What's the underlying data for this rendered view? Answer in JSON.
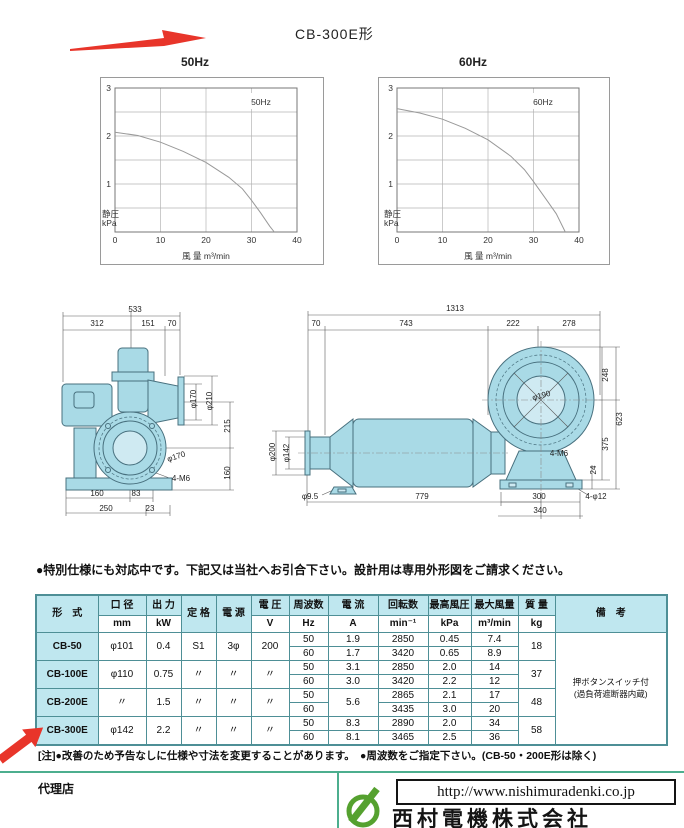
{
  "page_title": "CB-300E形",
  "chart_data": [
    {
      "type": "line",
      "title": "50Hz",
      "inner_label": "50Hz",
      "xlabel": "風 量  m³/min",
      "ylabel_lines": [
        "静圧",
        "kPa"
      ],
      "xlim": [
        0,
        40
      ],
      "ylim": [
        0,
        3
      ],
      "xticks": [
        0,
        10,
        20,
        30,
        40
      ],
      "yticks": [
        1,
        2,
        3
      ],
      "grid_x": [
        10,
        20,
        30
      ],
      "grid_y": [
        0.5,
        1,
        1.5,
        2,
        2.5
      ],
      "series": [
        {
          "name": "50Hz static pressure curve",
          "points": [
            [
              0,
              2.08
            ],
            [
              5,
              2.01
            ],
            [
              10,
              1.87
            ],
            [
              15,
              1.68
            ],
            [
              20,
              1.45
            ],
            [
              25,
              1.14
            ],
            [
              28,
              0.9
            ],
            [
              30,
              0.66
            ],
            [
              32,
              0.4
            ],
            [
              34,
              0.12
            ],
            [
              35,
              0
            ]
          ]
        }
      ]
    },
    {
      "type": "line",
      "title": "60Hz",
      "inner_label": "60Hz",
      "xlabel": "風 量  m³/min",
      "ylabel_lines": [
        "静圧",
        "kPa"
      ],
      "xlim": [
        0,
        40
      ],
      "ylim": [
        0,
        3
      ],
      "xticks": [
        0,
        10,
        20,
        30,
        40
      ],
      "yticks": [
        1,
        2,
        3
      ],
      "grid_x": [
        10,
        20,
        30
      ],
      "grid_y": [
        0.5,
        1,
        1.5,
        2,
        2.5
      ],
      "series": [
        {
          "name": "60Hz static pressure curve",
          "points": [
            [
              0,
              2.57
            ],
            [
              5,
              2.48
            ],
            [
              10,
              2.35
            ],
            [
              15,
              2.16
            ],
            [
              20,
              1.92
            ],
            [
              25,
              1.58
            ],
            [
              28,
              1.3
            ],
            [
              30,
              1.05
            ],
            [
              33,
              0.65
            ],
            [
              35,
              0.38
            ],
            [
              37,
              0
            ]
          ]
        }
      ]
    }
  ],
  "drawings": {
    "left": {
      "labels": [
        {
          "t": "533",
          "x": 85,
          "y": 14
        },
        {
          "t": "312",
          "x": 47,
          "y": 28
        },
        {
          "t": "151",
          "x": 98,
          "y": 28
        },
        {
          "t": "70",
          "x": 122,
          "y": 28
        },
        {
          "t": "φ170",
          "x": 146,
          "y": 101,
          "r": -90
        },
        {
          "t": "φ210",
          "x": 162,
          "y": 103,
          "r": -90
        },
        {
          "t": "215",
          "x": 180,
          "y": 128,
          "r": -90
        },
        {
          "t": "160",
          "x": 180,
          "y": 175,
          "r": -90
        },
        {
          "t": "φ170",
          "x": 127,
          "y": 161,
          "r": -18
        },
        {
          "t": "4-M6",
          "x": 131,
          "y": 183
        },
        {
          "t": "160",
          "x": 47,
          "y": 198
        },
        {
          "t": "83",
          "x": 86,
          "y": 198
        },
        {
          "t": "250",
          "x": 56,
          "y": 213
        },
        {
          "t": "23",
          "x": 100,
          "y": 213
        }
      ]
    },
    "right": {
      "labels": [
        {
          "t": "1313",
          "x": 197,
          "y": 16
        },
        {
          "t": "70",
          "x": 58,
          "y": 31
        },
        {
          "t": "743",
          "x": 148,
          "y": 31
        },
        {
          "t": "222",
          "x": 255,
          "y": 31
        },
        {
          "t": "278",
          "x": 311,
          "y": 31
        },
        {
          "t": "248",
          "x": 350,
          "y": 80,
          "r": -90
        },
        {
          "t": "623",
          "x": 364,
          "y": 124,
          "r": -90
        },
        {
          "t": "375",
          "x": 350,
          "y": 149,
          "r": -90
        },
        {
          "t": "24",
          "x": 338,
          "y": 175,
          "r": -90
        },
        {
          "t": "φ190",
          "x": 284,
          "y": 103,
          "r": -15
        },
        {
          "t": "4-M6",
          "x": 301,
          "y": 161
        },
        {
          "t": "φ200",
          "x": 17,
          "y": 157,
          "r": -90
        },
        {
          "t": "φ142",
          "x": 31,
          "y": 158,
          "r": -90
        },
        {
          "t": "φ9.5",
          "x": 52,
          "y": 204
        },
        {
          "t": "779",
          "x": 164,
          "y": 204
        },
        {
          "t": "300",
          "x": 281,
          "y": 204
        },
        {
          "t": "340",
          "x": 282,
          "y": 218
        },
        {
          "t": "4-φ12",
          "x": 338,
          "y": 204
        }
      ]
    }
  },
  "spec_note": "●特別仕様にも対応中です。下記又は当社へお引合下さい。設計用は専用外形図をご請求ください。",
  "table": {
    "columns": [
      {
        "label": "形　式"
      },
      {
        "label": "口 径",
        "unit": "mm"
      },
      {
        "label": "出 力",
        "unit": "kW"
      },
      {
        "label": "定 格"
      },
      {
        "label": "電 源"
      },
      {
        "label": "電 圧",
        "unit": "V"
      },
      {
        "label": "周波数",
        "unit": "Hz"
      },
      {
        "label": "電 流",
        "unit": "A"
      },
      {
        "label": "回転数",
        "unit": "min⁻¹"
      },
      {
        "label": "最高風圧",
        "unit": "kPa"
      },
      {
        "label": "最大風量",
        "unit": "m³/min"
      },
      {
        "label": "質 量",
        "unit": "kg"
      },
      {
        "label": "備　考"
      }
    ],
    "rows": [
      {
        "model": "CB-50",
        "bore": "φ101",
        "power": "0.4",
        "rating": "S1",
        "source": "3φ",
        "voltage": "200",
        "mass": "18",
        "freq": [
          {
            "hz": "50",
            "a": "1.9",
            "rpm": "2850",
            "kpa": "0.45",
            "flow": "7.4"
          },
          {
            "hz": "60",
            "a": "1.7",
            "rpm": "3420",
            "kpa": "0.65",
            "flow": "8.9"
          }
        ]
      },
      {
        "model": "CB-100E",
        "bore": "φ110",
        "power": "0.75",
        "rating": "〃",
        "source": "〃",
        "voltage": "〃",
        "mass": "37",
        "freq": [
          {
            "hz": "50",
            "a": "3.1",
            "rpm": "2850",
            "kpa": "2.0",
            "flow": "14"
          },
          {
            "hz": "60",
            "a": "3.0",
            "rpm": "3420",
            "kpa": "2.2",
            "flow": "12"
          }
        ]
      },
      {
        "model": "CB-200E",
        "bore": "〃",
        "power": "1.5",
        "rating": "〃",
        "source": "〃",
        "voltage": "〃",
        "mass": "48",
        "a_merged": "5.6",
        "freq": [
          {
            "hz": "50",
            "rpm": "2865",
            "kpa": "2.1",
            "flow": "17"
          },
          {
            "hz": "60",
            "rpm": "3435",
            "kpa": "3.0",
            "flow": "20"
          }
        ]
      },
      {
        "model": "CB-300E",
        "bore": "φ142",
        "power": "2.2",
        "rating": "〃",
        "source": "〃",
        "voltage": "〃",
        "mass": "58",
        "freq": [
          {
            "hz": "50",
            "a": "8.3",
            "rpm": "2890",
            "kpa": "2.0",
            "flow": "34"
          },
          {
            "hz": "60",
            "a": "8.1",
            "rpm": "3465",
            "kpa": "2.5",
            "flow": "36"
          }
        ]
      }
    ],
    "remarks_lines": [
      "押ボタンスイッチ付",
      "(過負荷遮断器内蔵)"
    ]
  },
  "footnote": "[注]●改善のため予告なしに仕様や寸法を変更することがあります。　●周波数をご指定下さい。(CB-50・200E形は除く)",
  "footer": {
    "dealer_label": "代理店",
    "url": "http://www.nishimuradenki.co.jp",
    "company": "西村電機株式会社"
  },
  "colors": {
    "accent_red": "#e8352a",
    "table_line": "#4e8f96",
    "table_header_bg": "#bfe7ef",
    "drawing_fill": "#a9dae6",
    "footer_line": "#4cae8e",
    "logo_green": "#55a12f"
  }
}
